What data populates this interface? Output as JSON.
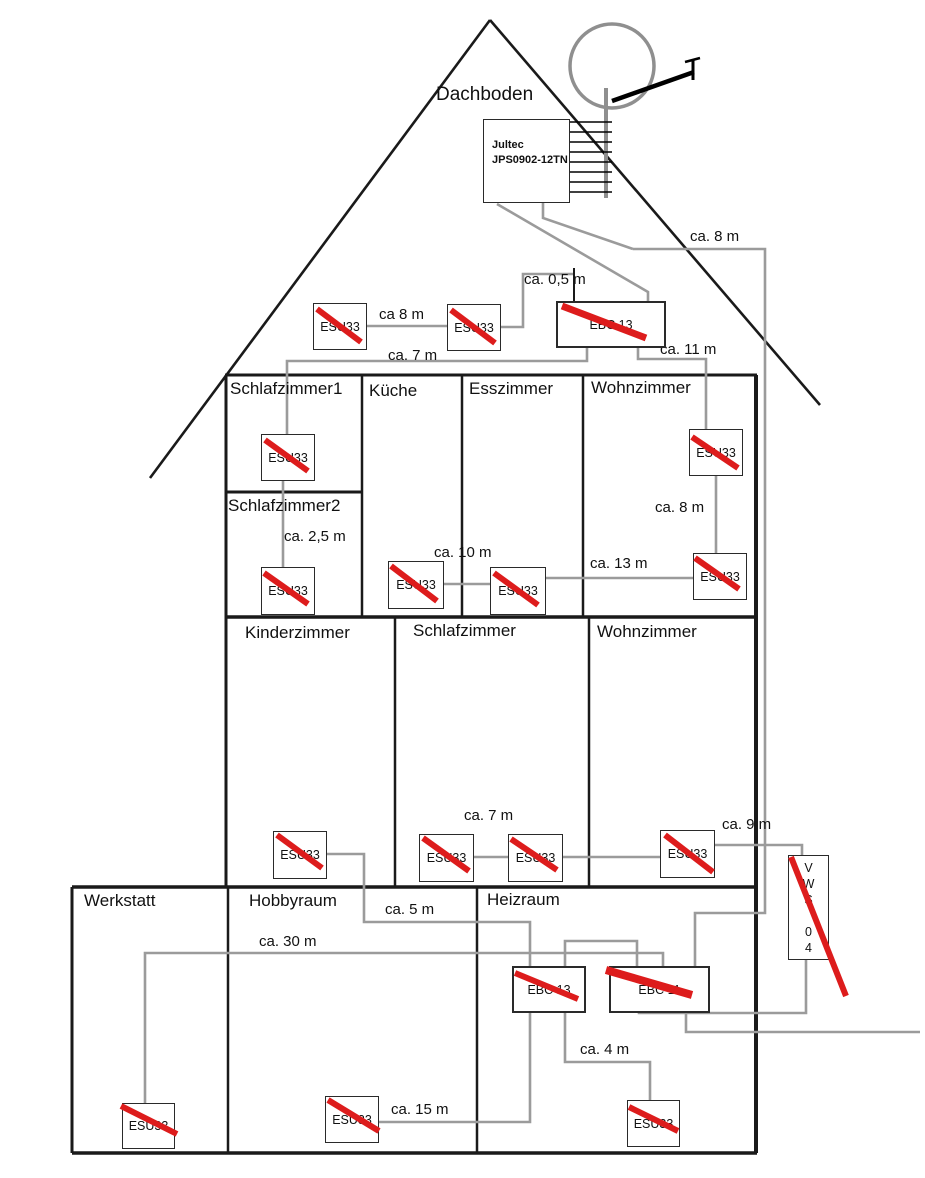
{
  "attic": {
    "label": "Dachboden",
    "multiswitch_line1": "Jultec",
    "multiswitch_line2": "JPS0902-12TN"
  },
  "device_labels": {
    "esu": "ESU33",
    "ebc13": "EBC 13",
    "ebc11": "EBC 11",
    "vws": "V\nW\nS\n\n0\n4"
  },
  "rooms": {
    "schlafzimmer1": "Schlafzimmer1",
    "kueche": "Küche",
    "esszimmer": "Esszimmer",
    "wohnzimmer_og": "Wohnzimmer",
    "schlafzimmer2": "Schlafzimmer2",
    "kinderzimmer": "Kinderzimmer",
    "schlafzimmer_eg": "Schlafzimmer",
    "wohnzimmer_eg": "Wohnzimmer",
    "werkstatt": "Werkstatt",
    "hobbyraum": "Hobbyraum",
    "heizraum": "Heizraum"
  },
  "cables": {
    "ca8_attic": "ca 8 m",
    "ca05": "ca. 0,5 m",
    "ca7_og": "ca. 7 m",
    "ca11": "ca. 11 m",
    "ca8_right": "ca. 8 m",
    "ca25": "ca. 2,5 m",
    "ca10": "ca. 10 m",
    "ca13": "ca. 13 m",
    "ca8_wz": "ca. 8 m",
    "ca7_eg": "ca. 7 m",
    "ca9": "ca. 9 m",
    "ca5": "ca. 5 m",
    "ca30": "ca. 30 m",
    "ca15": "ca. 15 m",
    "ca4": "ca. 4 m"
  },
  "colors": {
    "cable_gray": "#9b9b9b",
    "structure_black": "#1a1a1a",
    "strike_red": "#dd1c1c"
  }
}
